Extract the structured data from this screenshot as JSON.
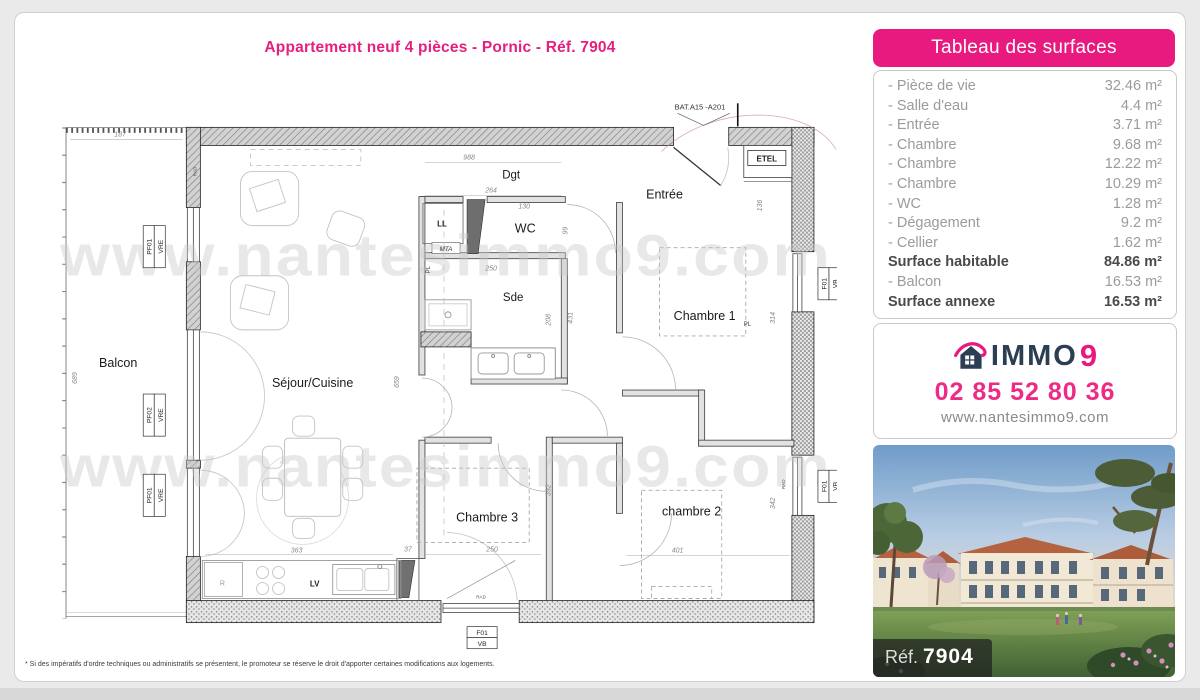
{
  "page": {
    "title": "Appartement neuf 4 pièces - Pornic - Réf. 7904",
    "footnote": "* Si des impératifs d'ordre techniques ou administratifs se présentent, le promoteur se réserve le droit d'apporter certaines modifications aux logements.",
    "accent_color": "#e91a7f"
  },
  "surfaces_panel": {
    "title": "Tableau des surfaces",
    "rows": [
      {
        "label": "- Pièce de vie",
        "value": "32.46 m²"
      },
      {
        "label": "- Salle d'eau",
        "value": "4.4 m²"
      },
      {
        "label": "- Entrée",
        "value": "3.71 m²"
      },
      {
        "label": "- Chambre",
        "value": "9.68 m²"
      },
      {
        "label": "- Chambre",
        "value": "12.22 m²"
      },
      {
        "label": "- Chambre",
        "value": "10.29 m²"
      },
      {
        "label": "- WC",
        "value": "1.28 m²"
      },
      {
        "label": "- Dégagement",
        "value": "9.2 m²"
      },
      {
        "label": "- Cellier",
        "value": "1.62 m²"
      },
      {
        "label": "Surface habitable",
        "value": "84.86 m²"
      },
      {
        "label": "- Balcon",
        "value": "16.53 m²"
      },
      {
        "label": "Surface annexe",
        "value": "16.53 m²"
      }
    ]
  },
  "contact_panel": {
    "brand_immo": "IMMO",
    "brand_9": "9",
    "phone": "02 85 52 80 36",
    "website": "www.nantesimmo9.com"
  },
  "photo_panel": {
    "ref_label": "Réf.",
    "ref_number": "7904"
  },
  "plan": {
    "unit_ref": "BAT.A15 -A201",
    "watermark": "www.nantesimmo9.com",
    "rooms": {
      "balcon": "Balcon",
      "sejour": "Séjour/Cuisine",
      "dgt": "Dgt",
      "wc": "WC",
      "sde": "Sde",
      "entree": "Entrée",
      "ch1": "Chambre 1",
      "ch1_pl": "PL",
      "ch2": "chambre 2",
      "ch3": "Chambre 3"
    },
    "fixtures": {
      "etel": "ETEL",
      "ll": "LL",
      "mta": "MTA",
      "pl": "PL",
      "r": "R",
      "lv": "LV",
      "rad": "RAD"
    },
    "window_labels": {
      "pf01": "PF01",
      "pf02": "PF02",
      "vre": "VRE",
      "f01": "F01",
      "vb": "VB"
    },
    "dims": {
      "balcon_w": "187",
      "balcon_h": "689",
      "hall_w": "988",
      "dgt_w": "264",
      "wc_w": "130",
      "wc_h": "99",
      "sde_w": "250",
      "sde_h": "208",
      "sde_h2": "431",
      "sejour_h": "659",
      "etel_h": "136",
      "ch1_h": "314",
      "kitchen_w": "363",
      "gap_w": "37",
      "ch3_w": "250",
      "ch3_h": "392",
      "ch2_w": "401",
      "ch2_h": "342"
    }
  }
}
